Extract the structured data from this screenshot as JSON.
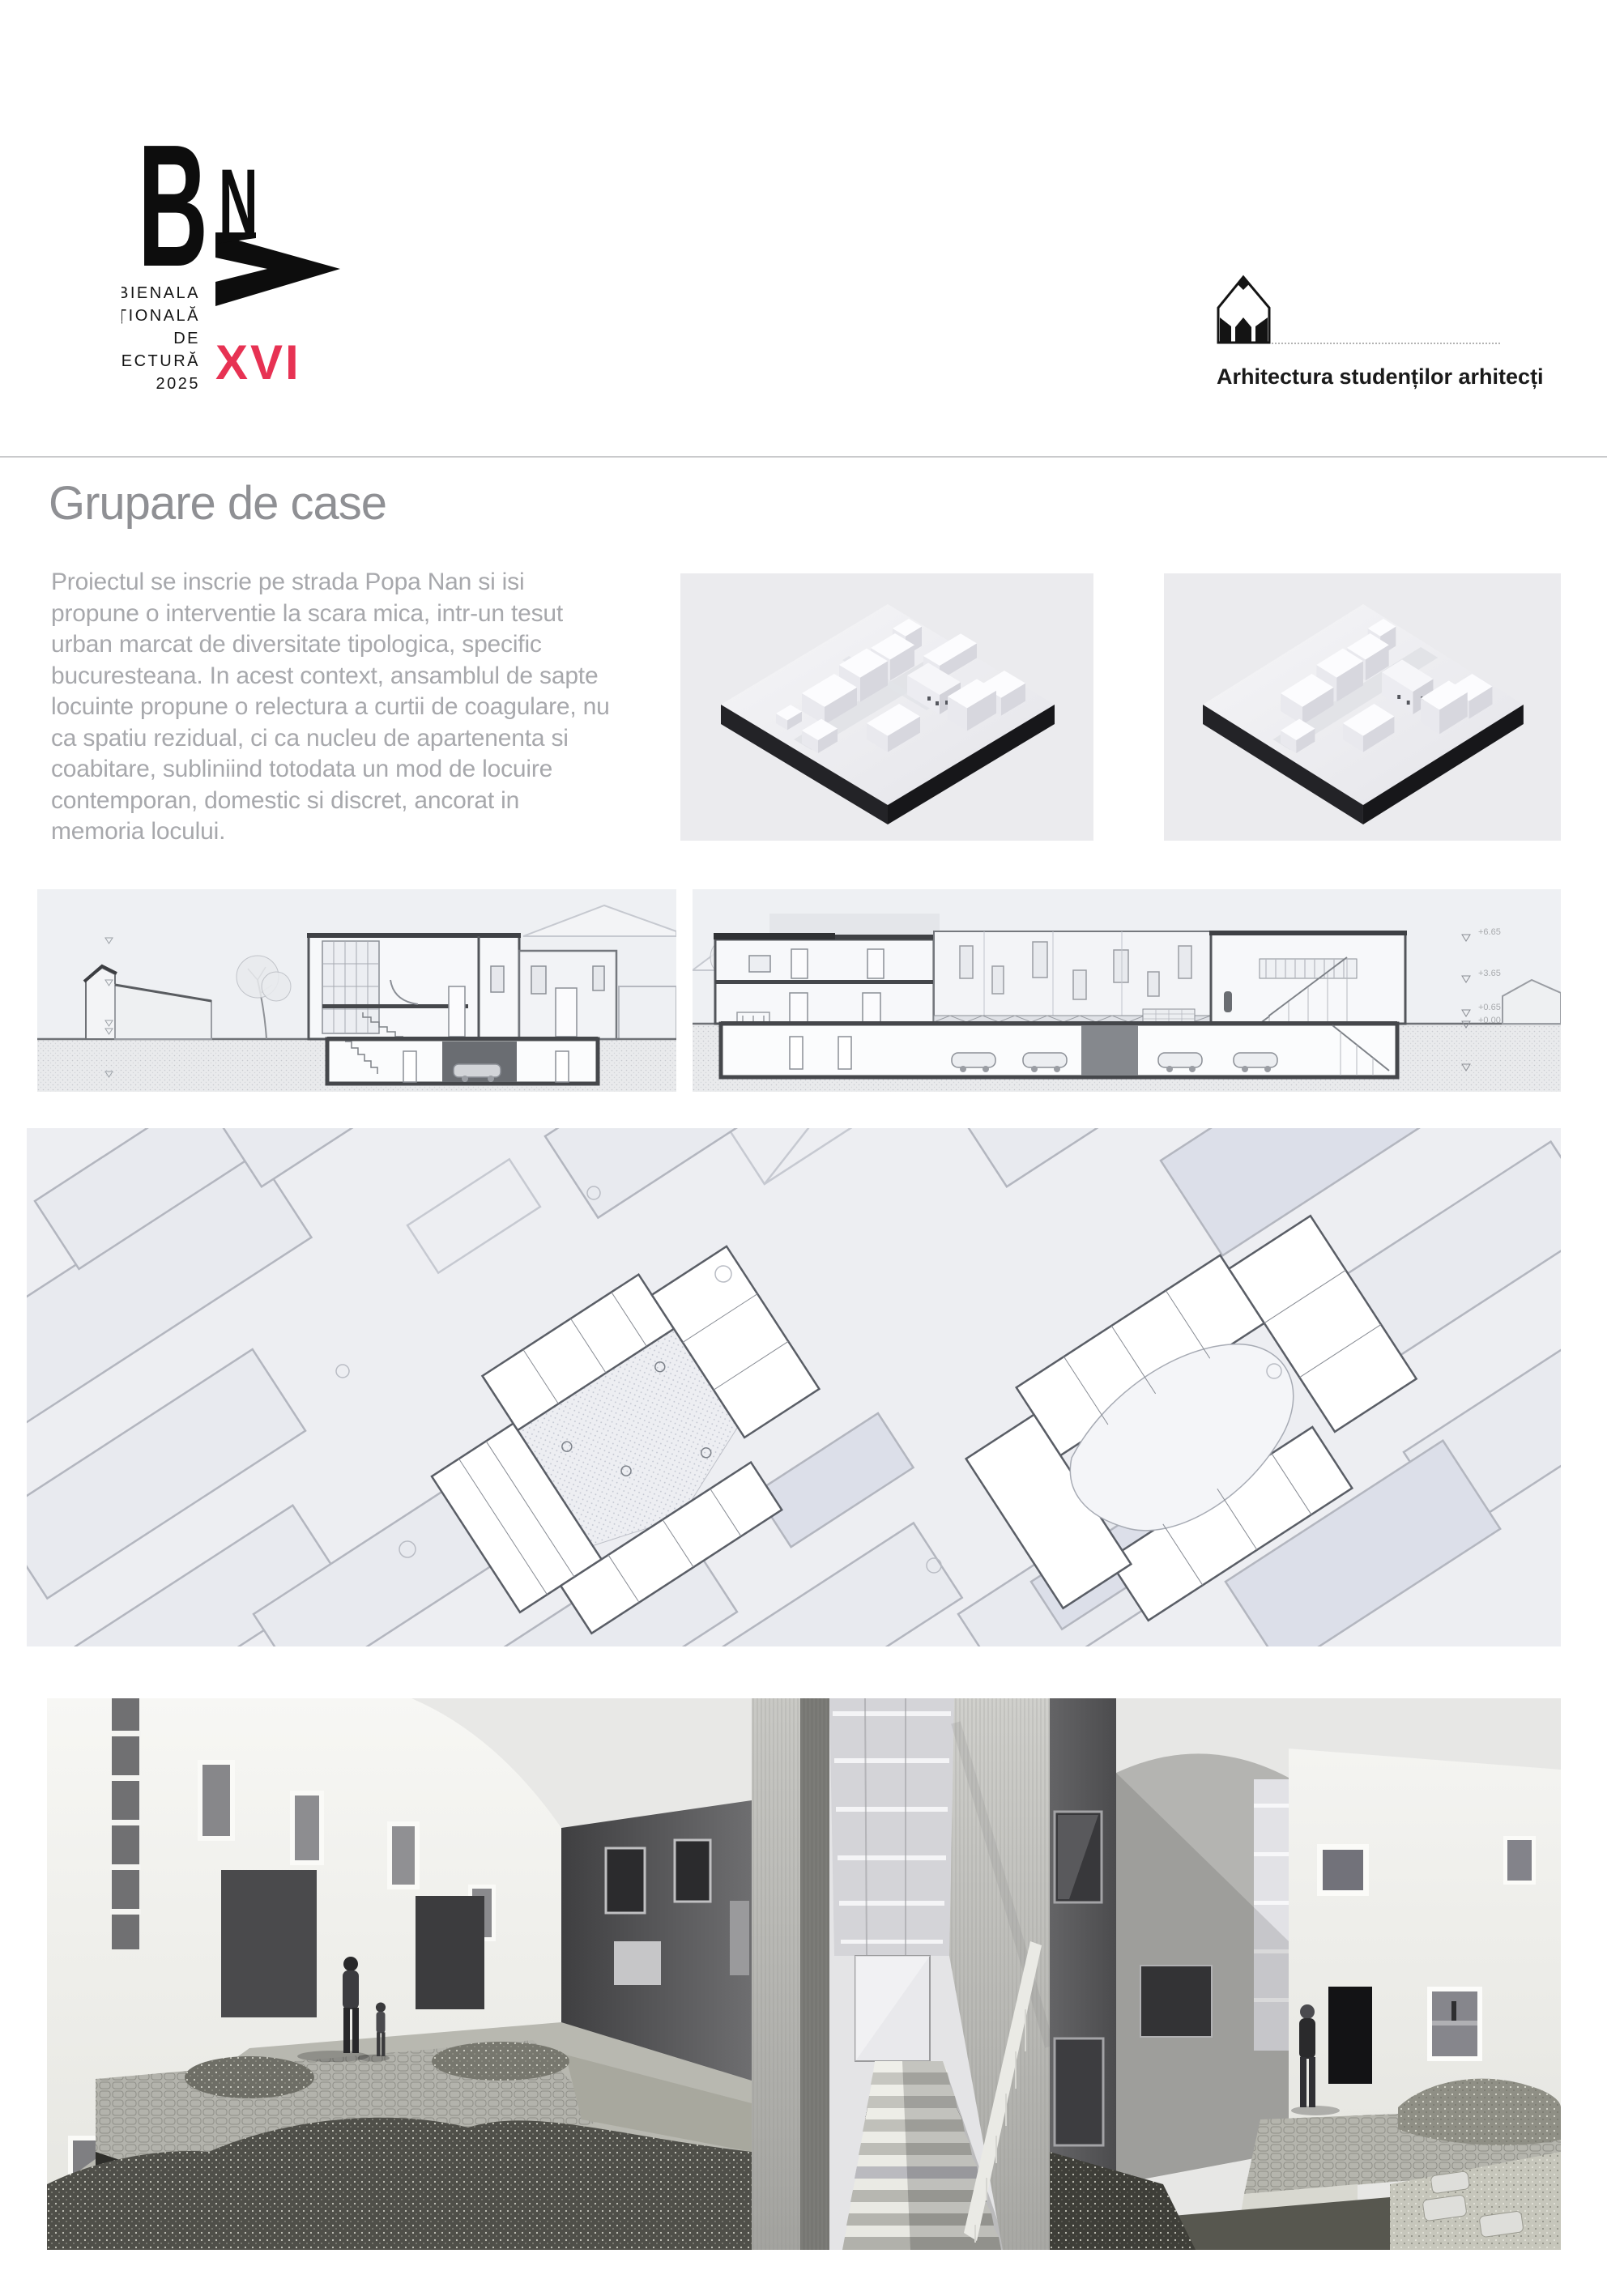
{
  "header": {
    "bna": {
      "letter_b": "B",
      "letter_n": "N",
      "letter_a": "A",
      "title_lines": [
        "BIENALA",
        "NAȚIONALĂ",
        "DE",
        "ARHITECTURĂ"
      ],
      "year": "2025",
      "edition": "XVI",
      "edition_color": "#e73253"
    },
    "section_logo": {
      "icon": "pencil-house-icon",
      "label": "Arhitectura studenților arhitecți"
    }
  },
  "intro": {
    "title": "Grupare de case",
    "paragraph": "Proiectul se inscrie pe strada Popa Nan si isi\npropune o interventie la scara mica, intr-un tesut\nurban marcat de diversitate tipologica, specific\nbucuresteana. In acest context, ansamblul de sapte\nlocuinte propune o relectura a curtii de coagulare, nu\nca spatiu rezidual, ci ca nucleu de apartenenta si\ncoabitare, subliniind totodata un mod de locuire\ncontemporan, domestic si discret, ancorat in\nmemoria locului."
  },
  "figures": {
    "axon_left": {
      "name": "site-axonometric-view-1"
    },
    "axon_right": {
      "name": "site-axonometric-view-2"
    },
    "section_left": {
      "name": "cross-section-a"
    },
    "section_right": {
      "name": "cross-section-b",
      "levels": [
        "+6.65",
        "+3.65",
        "+0.65",
        "+0.00"
      ]
    },
    "site_plan": {
      "name": "site-plan-with-floor-plans"
    },
    "render_left": {
      "name": "courtyard-render-left"
    },
    "render_middle": {
      "name": "stair-alley-render"
    },
    "render_right": {
      "name": "courtyard-render-right"
    }
  },
  "colors": {
    "accent": "#e73253",
    "panel_bg": "#ebebee",
    "drawing_bg": "#eef0f3",
    "plan_bg": "#edeef2",
    "divider": "#c9cacc",
    "title_text": "#8f9094",
    "body_text": "#a7a8ac",
    "logo_text": "#141414"
  }
}
